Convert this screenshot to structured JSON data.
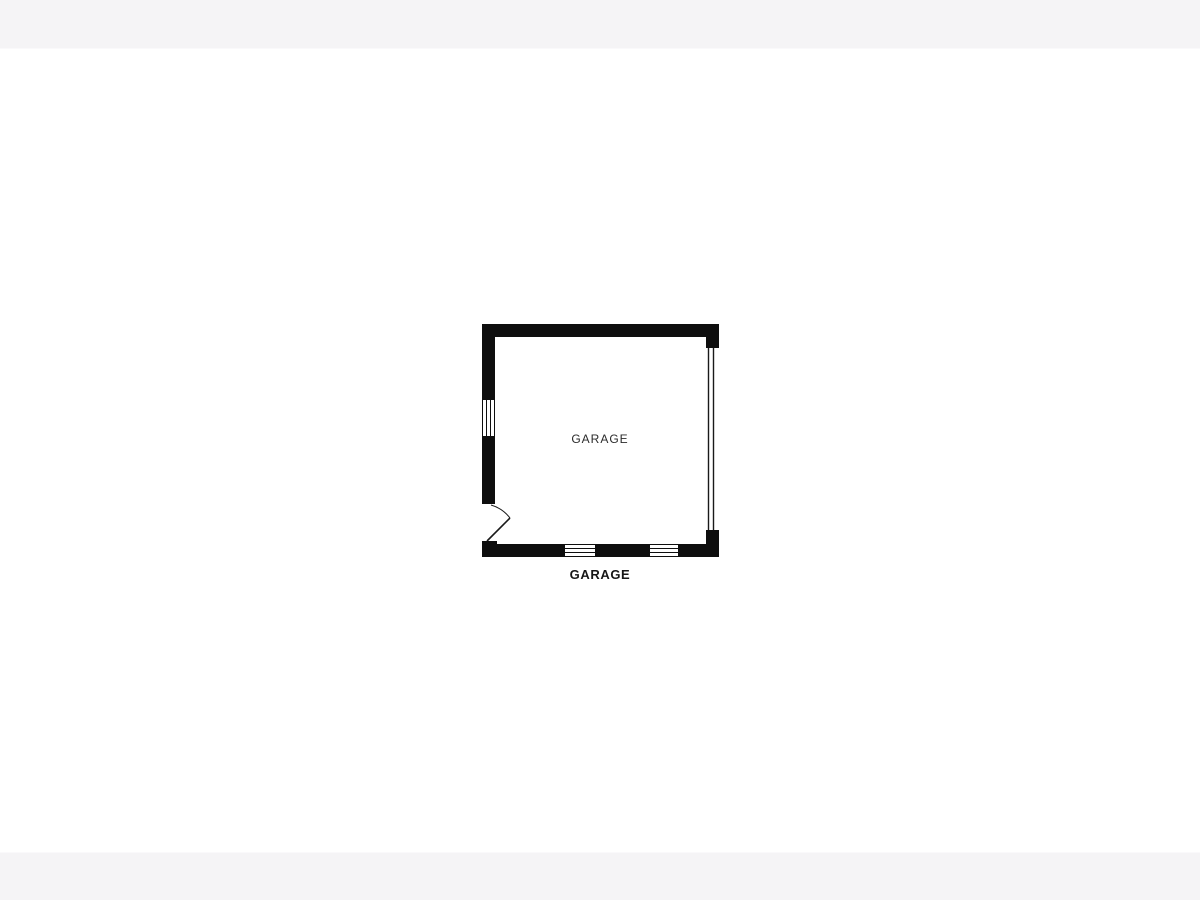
{
  "page": {
    "background_color": "#ffffff",
    "band_color": "#f5f4f6"
  },
  "floorplan": {
    "room_label": "GARAGE",
    "caption": "GARAGE",
    "wall_color": "#0e0e0e",
    "room_label_color": "#2b2b2b",
    "caption_color": "#161616",
    "features": [
      {
        "side": "left",
        "type": "window"
      },
      {
        "side": "left",
        "type": "entry-door",
        "swing": "inward"
      },
      {
        "side": "right",
        "type": "garage-door-opening"
      },
      {
        "side": "bottom",
        "type": "window"
      },
      {
        "side": "bottom",
        "type": "window"
      }
    ]
  }
}
